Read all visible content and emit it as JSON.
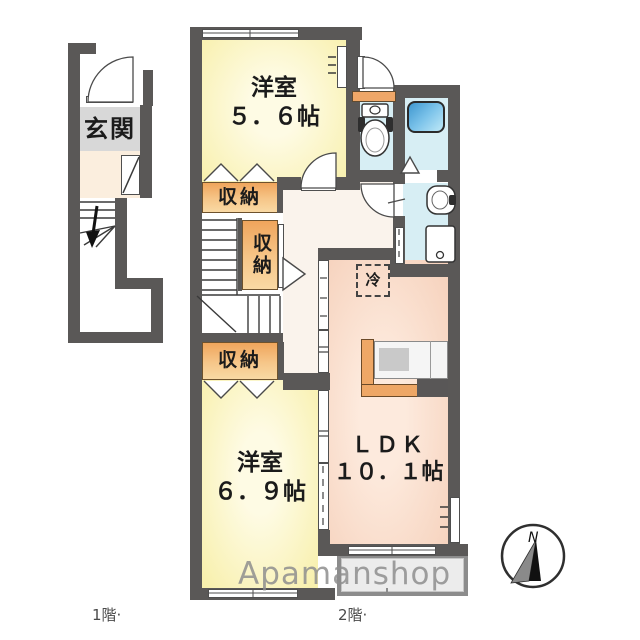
{
  "floor1": {
    "label": "1階·",
    "entrance": "玄関"
  },
  "floor2": {
    "label": "2階·",
    "bedroom_top": {
      "name": "洋室",
      "size": "５．６帖"
    },
    "bedroom_bottom": {
      "name": "洋室",
      "size": "６．９帖"
    },
    "ldk": {
      "name": "ＬＤＫ",
      "size": "１０．１帖"
    },
    "storage_top": "収納",
    "storage_middle": "収納",
    "storage_bottom": "収納",
    "refrigerator": "冷"
  },
  "watermark": "Apamanshop",
  "compass": {
    "north_label": "N"
  },
  "colors": {
    "wall": "#5a5857",
    "bedroom_fill": "#f8f0ad",
    "ldk_fill": "#f6d2bd",
    "storage_fill": "#f0a75f",
    "wet_area_fill": "#d7eef4",
    "tub_fill": "#4a9fd6",
    "entrance_tile": "#d8d8d8",
    "hall_fill": "#faf3ec",
    "kitchen_counter_fill": "#eea766",
    "balcony_fill": "#ececec",
    "watermark_gray": "#8f8f8f"
  }
}
